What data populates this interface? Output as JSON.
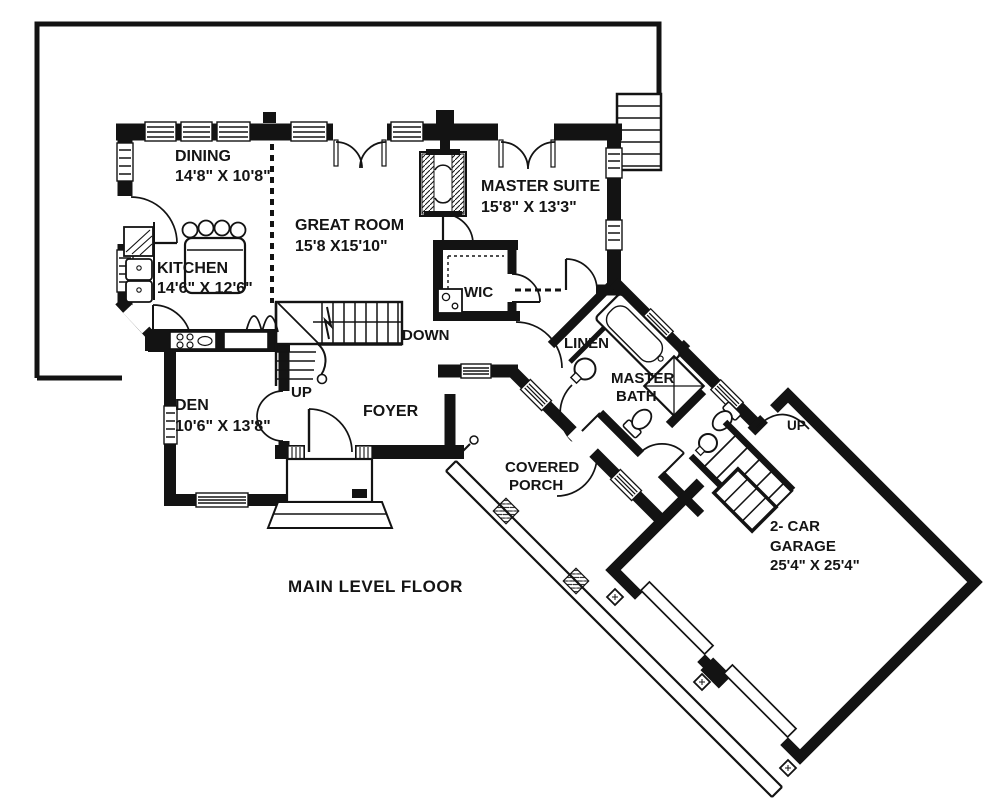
{
  "page": {
    "background": "#ffffff",
    "ink": "#131313"
  },
  "title": {
    "label": "MAIN LEVEL FLOOR"
  },
  "rooms": {
    "dining": {
      "name": "DINING",
      "dims": "14'8\" X 10'8\""
    },
    "kitchen": {
      "name": "KITCHEN",
      "dims": "14'6\" X 12'6\""
    },
    "great_room": {
      "name": "GREAT ROOM",
      "dims": "15'8 X15'10\""
    },
    "master_suite": {
      "name": "MASTER SUITE",
      "dims": "15'8\" X 13'3\""
    },
    "wic": {
      "name": "WIC"
    },
    "den": {
      "name": "DEN",
      "dims": "10'6\" X 13'8\""
    },
    "foyer": {
      "name": "FOYER"
    },
    "linen": {
      "name": "LINEN"
    },
    "master_bath": {
      "name_line1": "MASTER",
      "name_line2": "BATH"
    },
    "covered_porch": {
      "name_line1": "COVERED",
      "name_line2": "PORCH"
    },
    "garage": {
      "name_line1": "2- CAR",
      "name_line2": "GARAGE",
      "dims": "25'4\" X 25'4\""
    }
  },
  "stairs": {
    "main_up": "UP",
    "main_down": "DOWN",
    "garage_up": "UP"
  }
}
